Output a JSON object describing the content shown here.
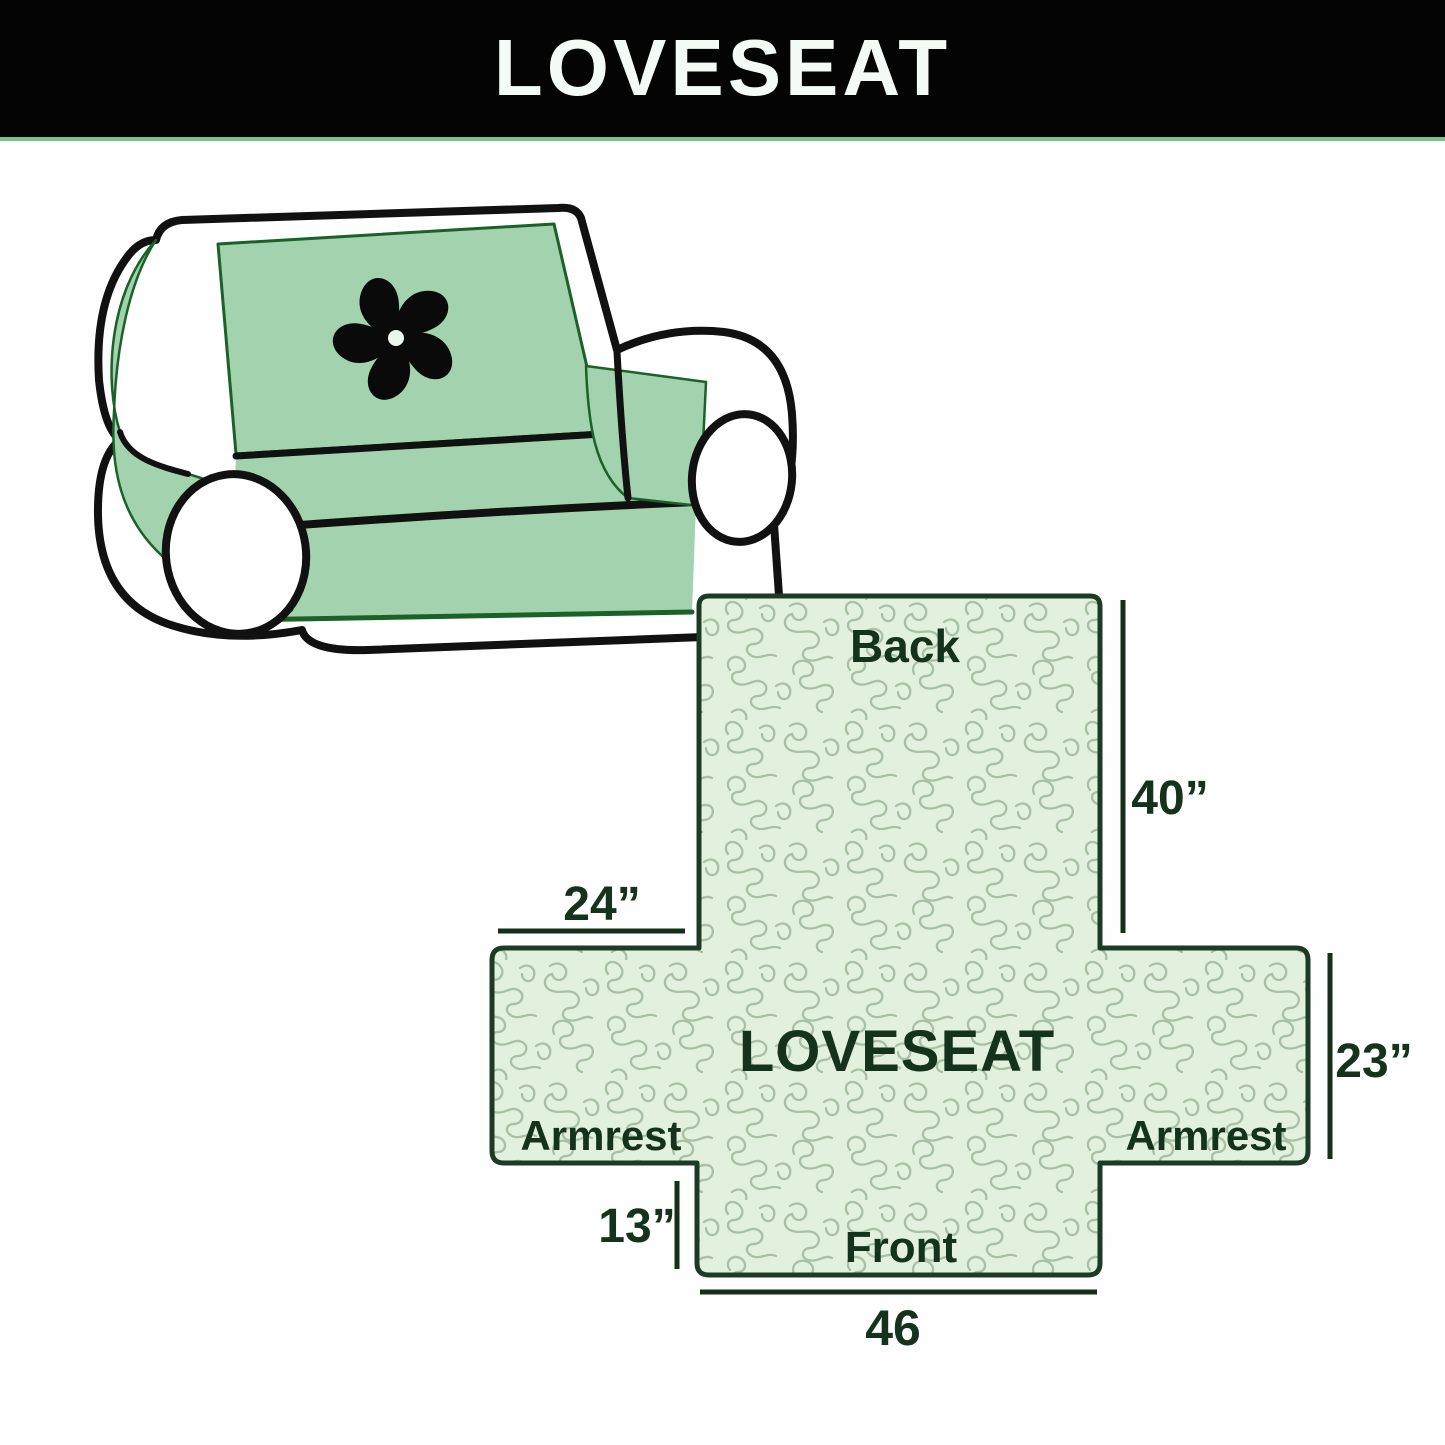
{
  "banner": {
    "title": "LOVESEAT"
  },
  "diagram": {
    "center_label": "LOVESEAT",
    "back_label": "Back",
    "front_label": "Front",
    "armrest_left_label": "Armrest",
    "armrest_right_label": "Armrest",
    "dim_back_height": "40”",
    "dim_armrest_width": "24”",
    "dim_armrest_height": "23”",
    "dim_front_skirt_height": "13”",
    "dim_front_width": "46"
  },
  "colors": {
    "banner_bg": "#040404",
    "banner_text": "#f4faf5",
    "banner_underline": "#7cc08d",
    "cover_green": "#a2d3ae",
    "cover_edge_green": "#1c6128",
    "pattern_bg": "#e2f1dd",
    "pattern_line": "#a8c0a4",
    "diagram_outline": "#1d3b24",
    "dimension_line": "#143018",
    "label_text": "#15321c",
    "sofa_outline": "#111111",
    "page_bg": "#fefefe"
  }
}
